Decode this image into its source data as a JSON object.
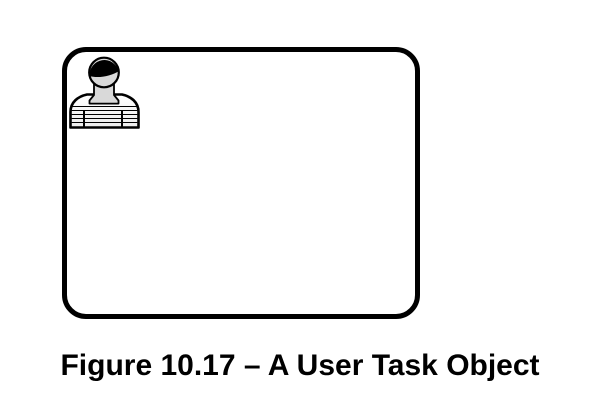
{
  "figure": {
    "caption": "Figure 10.17 – A User Task Object"
  },
  "diagram": {
    "shape": {
      "type": "rounded-rectangle",
      "meaning": "user-task-object",
      "outline_color": "#000000",
      "fill_color": "#ffffff"
    },
    "icon": {
      "name": "user-icon",
      "hair_color": "#000000",
      "skin_color": "#d9d9d9",
      "shirt_top_color": "#ffffff",
      "shirt_bottom_color": "#ececec",
      "outline_color": "#000000"
    }
  },
  "page": {
    "background_color": "#ffffff",
    "text_color": "#000000"
  }
}
